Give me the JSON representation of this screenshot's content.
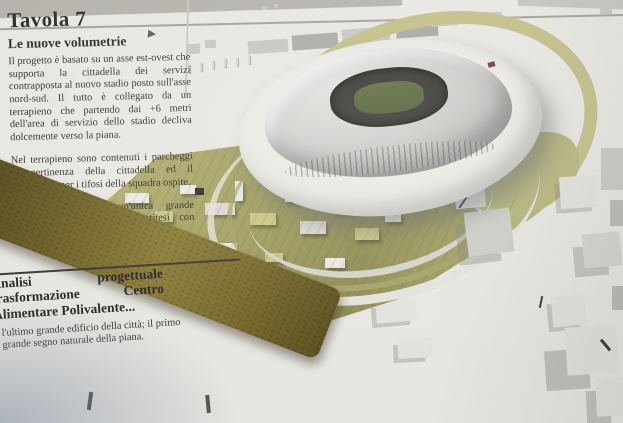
{
  "board": {
    "title": "Tavola 7",
    "subtitle": "Le nuove volumetrie",
    "paragraph_1": "Il progetto è basato su un asse est-ovest che supporta la cittadella dei servizi contrapposta al nuovo stadio posto sull'asse nord-sud. Il tutto è collegato da un terrapieno che partendo dai +6 metri dell'area di servizio dello stadio decliva dolcemente verso la piana.",
    "paragraph_2": "Nel terrapieno sono contenuti i parcheggi di pertinenza della cittadella ed il parcheggio per i tifosi della squadra ospite.",
    "paragraph_3": "Si propone quindi un'unica grande architettura territoriale in antitesi con l'ipotesi dello stadio \"astronave\"",
    "caption_heading": "Analisi progettuale trasformazione Centro Alimentare Polivalente...",
    "caption_note": "l'ultimo grande edificio della città; il primo grande segno naturale della piana."
  },
  "colors": {
    "board": "#e8e6e1",
    "ink": "#2f2d29",
    "terrain_light": "#b3b070",
    "terrain_dark": "#6e6128",
    "stadium_roof": "#c9c8c5",
    "stadium_opening": "#34322d",
    "pitch_green": "#4c5a31",
    "shadow_blue": "#7482a8"
  }
}
